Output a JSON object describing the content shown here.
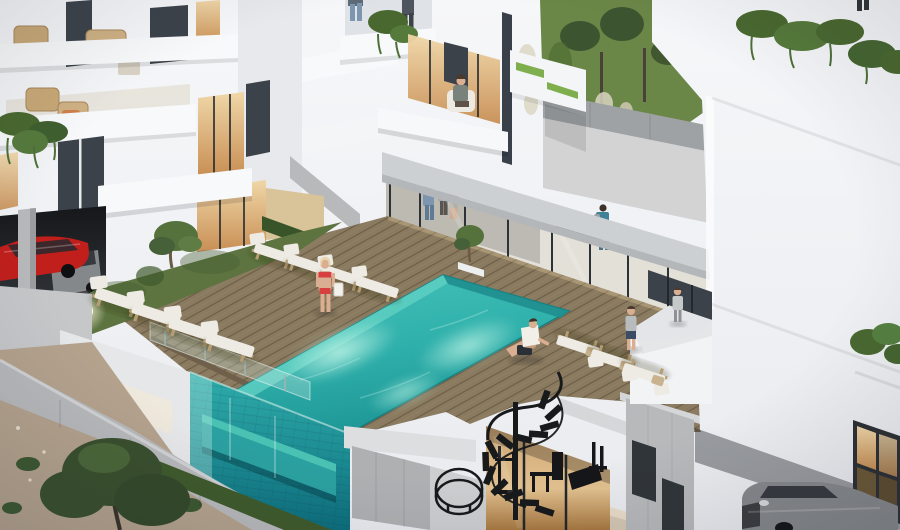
{
  "scene": {
    "type": "architectural-render",
    "subject": "modern white apartment complex with rooftop infinity pool terrace at dusk",
    "elements": [
      "left-apartment-building",
      "center-apartment-tower",
      "right-apartment-building",
      "rooftop-pool",
      "glass-infinity-pool-wall",
      "wooden-pool-deck",
      "sun-loungers",
      "grass-planter-strip",
      "globe-deck-lamp",
      "olive-tree",
      "hanging-ivy",
      "ground-floor-lounge-interior",
      "kitchen-island",
      "spiral-staircase",
      "gym-behind-glass",
      "parking-garage",
      "retaining-walls",
      "rocky-slope",
      "tree",
      "grass-hill",
      "pampas-grass",
      "woman-in-bikini",
      "man-sitting-poolside",
      "two-children-on-deck",
      "residents-indoors",
      "person-on-balcony",
      "red-car",
      "dark-grey-car",
      "silver-car"
    ],
    "people_count": 13
  },
  "colors": {
    "wall": "#f2f3f5",
    "wall_shade": "#e7e9ed",
    "wall_side": "#dfe2e6",
    "slab": "#cdd0d2",
    "concrete": "#b7b9bb",
    "concrete_dark": "#9ea2a4",
    "glass_dark": "#3b424a",
    "glass_frame": "#23282d",
    "warm_hi": "#f0d7a8",
    "warm_lo": "#c88f54",
    "interior": "#efe9df",
    "pool_hi": "#52cabe",
    "pool_lo": "#27a2a0",
    "pool_shelf": "#5ecfc2",
    "pool_wall_hi": "#2fadab",
    "pool_wall_lo": "#0c6e7d",
    "bench": "#49c2b4",
    "deck": "#8a7a5f",
    "deck_line": "#3e3423",
    "grass": "#5d7440",
    "grass_dark": "#3f5a2c",
    "hill": "#6b8747",
    "foliage": "#49682f",
    "tree_dark": "#394f2d",
    "lounger": "#edebe4",
    "lounger_frame": "#b59c74",
    "pillow": "#c9b28e",
    "stone": "#b4a28d",
    "path": "#c6c7c9",
    "stair": "#17191b",
    "car_red": "#c11f1c",
    "car_grey": "#85888b",
    "skin": "#d9ae91",
    "hair_blonde": "#e8d5b0",
    "bikini": "#d84040",
    "denim": "#7d96b0",
    "teal": "#3f8196",
    "towel": "#f1efe8",
    "navy": "#3d4c66",
    "grey_tee": "#b9bcbe"
  }
}
